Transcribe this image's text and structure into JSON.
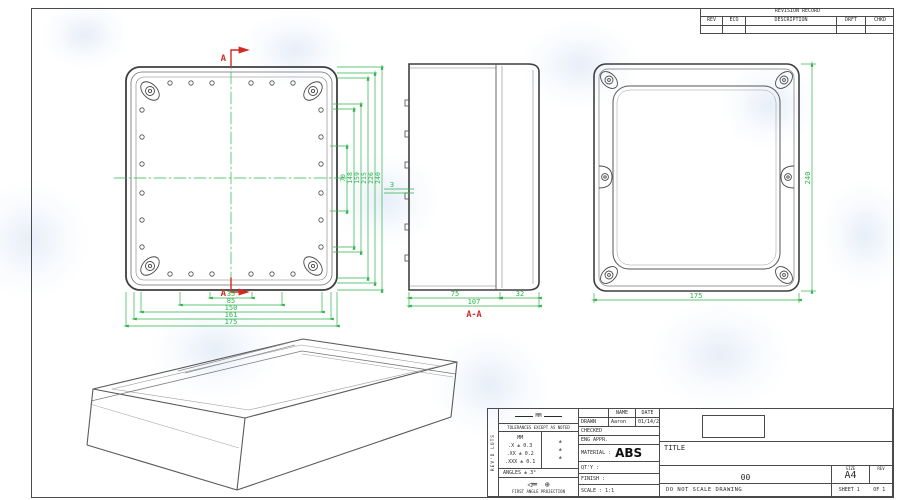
{
  "colors": {
    "dim_green": "#2db24b",
    "section_red": "#cf2b24",
    "line_dark": "#474747",
    "line_light": "#8a8a8a",
    "watermark_blue": "#aecbe8"
  },
  "revision_table": {
    "title": "REVISION RECORD",
    "columns": [
      "REV",
      "ECO",
      "DESCRIPTION",
      "DRFT",
      "CHKD"
    ]
  },
  "front_view": {
    "section_label_top": "A",
    "section_label_bottom": "A",
    "bottom_dims": [
      "35",
      "85",
      "150",
      "161",
      "175"
    ],
    "side_dims": [
      "70",
      "148",
      "159",
      "215",
      "226",
      "240"
    ]
  },
  "section_view": {
    "label": "A-A",
    "dim_body": "75",
    "dim_lid": "32",
    "dim_total": "107",
    "dim_wall": "3"
  },
  "back_view": {
    "dim_height": "240",
    "dim_width": "175"
  },
  "title_block": {
    "side_strip": "REV'D LOTS",
    "units_label": "MM",
    "tolerance_note": "TOLERANCES EXCEPT AS NOTED",
    "tol_col_header": "MM",
    "tolerances": [
      ".X ± 0.3",
      ".XX ± 0.2",
      ".XXX ± 0.1"
    ],
    "tol_marks": [
      "±",
      "±",
      "±"
    ],
    "angles": "ANGLES ± 3°",
    "projection": "FIRST ANGLE PROJECTION",
    "name_header": "NAME",
    "date_header": "DATE",
    "drawn_label": "DRAWN",
    "drawn_name": "Aaron",
    "drawn_date": "01/14/2015",
    "checked_label": "CHECKED",
    "eng_appr_label": "ENG APPR.",
    "material_label": "MATERIAL :",
    "material_value": "ABS",
    "qty_label": "QT'Y :",
    "finish_label": "FINISH :",
    "scale_label": "SCALE : 1:1",
    "title_label": "TITLE",
    "drawing_rev": "00",
    "size_label": "SIZE",
    "size_value": "A4",
    "rev_label": "REV",
    "no_scale": "DO NOT SCALE DRAWING",
    "sheet_label": "SHEET 1",
    "of_label": "OF 1"
  }
}
